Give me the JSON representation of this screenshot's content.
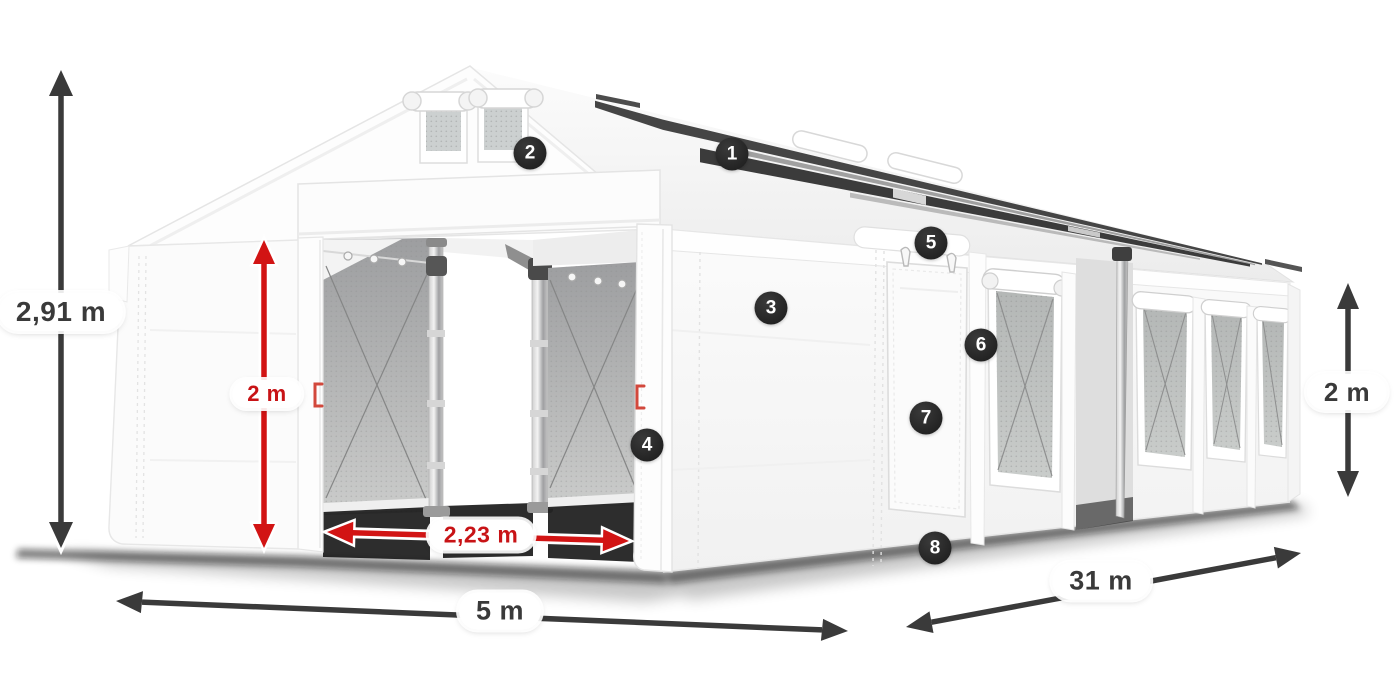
{
  "page": {
    "title": "Tent dimensions diagram",
    "background": "#ffffff"
  },
  "colors": {
    "dimension_dark": "#3a3a3a",
    "dimension_red": "#cd1316",
    "badge_background": "#262626",
    "badge_text": "#ffffff",
    "label_pill_background": "#ffffff"
  },
  "dimensions": {
    "total_height": "2,91 m",
    "entrance_height": "2 m",
    "entrance_width": "2,23 m",
    "tent_width": "5 m",
    "tent_length": "31 m",
    "side_wall_height": "2 m"
  },
  "callouts": [
    "1",
    "2",
    "3",
    "4",
    "5",
    "6",
    "7",
    "8"
  ]
}
